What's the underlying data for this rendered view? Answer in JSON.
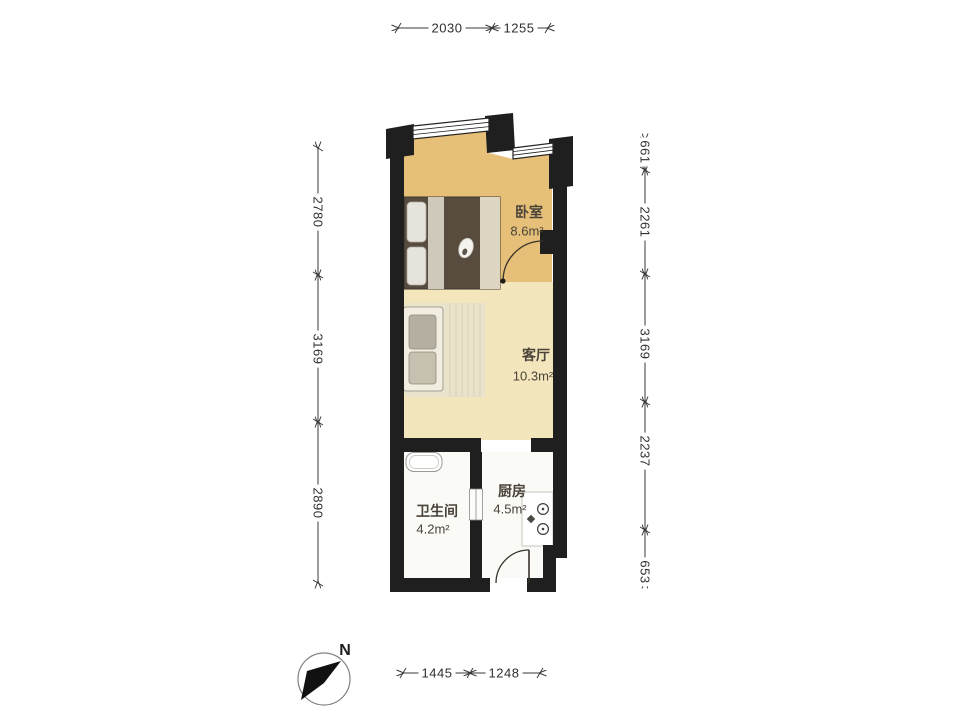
{
  "floor_plan": {
    "compass_label": "N",
    "rooms": {
      "bedroom": {
        "name": "卧室",
        "area": "8.6m²"
      },
      "living_room": {
        "name": "客厅",
        "area": "10.3m²"
      },
      "bathroom": {
        "name": "卫生间",
        "area": "4.2m²"
      },
      "kitchen": {
        "name": "厨房",
        "area": "4.5m²"
      }
    },
    "dimensions_mm": {
      "top": [
        "2030",
        "1255"
      ],
      "bottom": [
        "1445",
        "1248"
      ],
      "left": [
        "2780",
        "3169",
        "2890"
      ],
      "right": [
        "661",
        "2261",
        "3169",
        "2237",
        "653"
      ]
    },
    "colors": {
      "wall": "#1f1f1f",
      "bedroom_floor": "#e6bf79",
      "living_floor": "#f3e6bd",
      "wet_floor": "#fafaf6"
    }
  }
}
